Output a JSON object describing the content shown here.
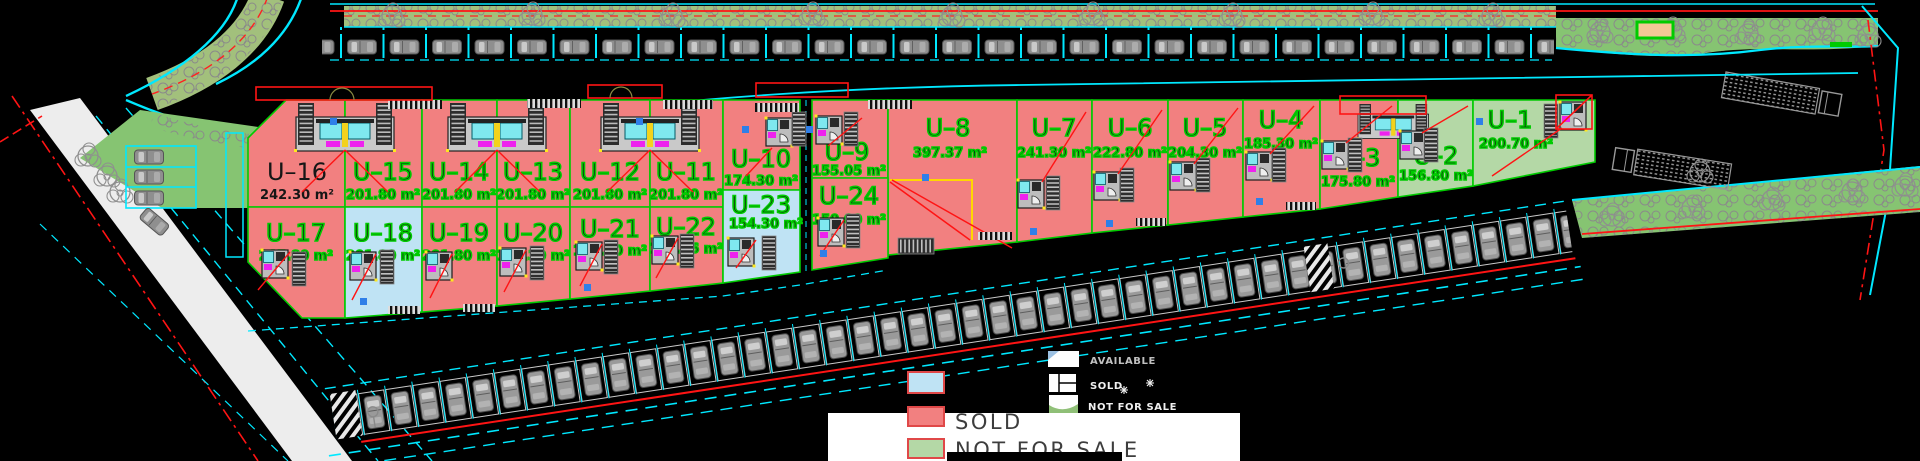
{
  "units": [
    {
      "id": "U–1",
      "area": "200.70 m²",
      "status": "not-for-sale",
      "color": "#B4D8A6"
    },
    {
      "id": "U–2",
      "area": "156.80 m²",
      "status": "not-for-sale",
      "color": "#B4D8A6"
    },
    {
      "id": "U–3",
      "area": "175.80 m²",
      "status": "sold",
      "color": "#F28080"
    },
    {
      "id": "U–4",
      "area": "185.30 m²",
      "status": "sold",
      "color": "#F28080"
    },
    {
      "id": "U–5",
      "area": "204.30 m²",
      "status": "sold",
      "color": "#F28080"
    },
    {
      "id": "U–6",
      "area": "222.80 m²",
      "status": "sold",
      "color": "#F28080"
    },
    {
      "id": "U–7",
      "area": "241.30 m²",
      "status": "sold",
      "color": "#F28080"
    },
    {
      "id": "U–8",
      "area": "397.37 m²",
      "status": "sold",
      "color": "#F28080"
    },
    {
      "id": "U–9",
      "area": "155.05 m²",
      "status": "sold",
      "color": "#F28080"
    },
    {
      "id": "U–10",
      "area": "174.30 m²",
      "status": "sold",
      "color": "#F28080"
    },
    {
      "id": "U–11",
      "area": "201.80 m²",
      "status": "sold",
      "color": "#F28080"
    },
    {
      "id": "U–12",
      "area": "201.80 m²",
      "status": "sold",
      "color": "#F28080"
    },
    {
      "id": "U–13",
      "area": "201.80 m²",
      "status": "sold",
      "color": "#F28080"
    },
    {
      "id": "U–14",
      "area": "201.80 m²",
      "status": "sold",
      "color": "#F28080"
    },
    {
      "id": "U–15",
      "area": "201.80 m²",
      "status": "sold",
      "color": "#F28080"
    },
    {
      "id": "U–16",
      "area": "242.30 m²",
      "status": "sold",
      "color": "#F28080"
    },
    {
      "id": "U–17",
      "area": "215.80 m²",
      "status": "sold",
      "color": "#F28080"
    },
    {
      "id": "U–18",
      "area": "201.80 m²",
      "status": "available",
      "color": "#BFE3F4"
    },
    {
      "id": "U–19",
      "area": "201.80 m²",
      "status": "sold",
      "color": "#F28080"
    },
    {
      "id": "U–20",
      "area": "183.30 m²",
      "status": "sold",
      "color": "#F28080"
    },
    {
      "id": "U–21",
      "area": "164.30 m²",
      "status": "sold",
      "color": "#F28080"
    },
    {
      "id": "U–22",
      "area": "139.96 m²",
      "status": "sold",
      "color": "#F28080"
    },
    {
      "id": "U–23",
      "area": "154.30 m²",
      "status": "available",
      "color": "#BFE3F4"
    },
    {
      "id": "U–24",
      "area": "150.00 m²",
      "status": "sold",
      "color": "#F28080"
    }
  ],
  "legend": {
    "main": {
      "sold": "SOLD",
      "not_for_sale": "NOT FOR SALE"
    },
    "small": {
      "available": "AVAILABLE",
      "sold": "SOLD",
      "not_for_sale": "NOT FOR SALE"
    }
  },
  "colors": {
    "available": "#BFE3F4",
    "sold": "#F28080",
    "not_for_sale": "#B4D8A6",
    "swatch_border": "#E04848",
    "line_green": "#00CB00",
    "line_cyan": "#00E8FF",
    "line_red": "#FF1414"
  }
}
